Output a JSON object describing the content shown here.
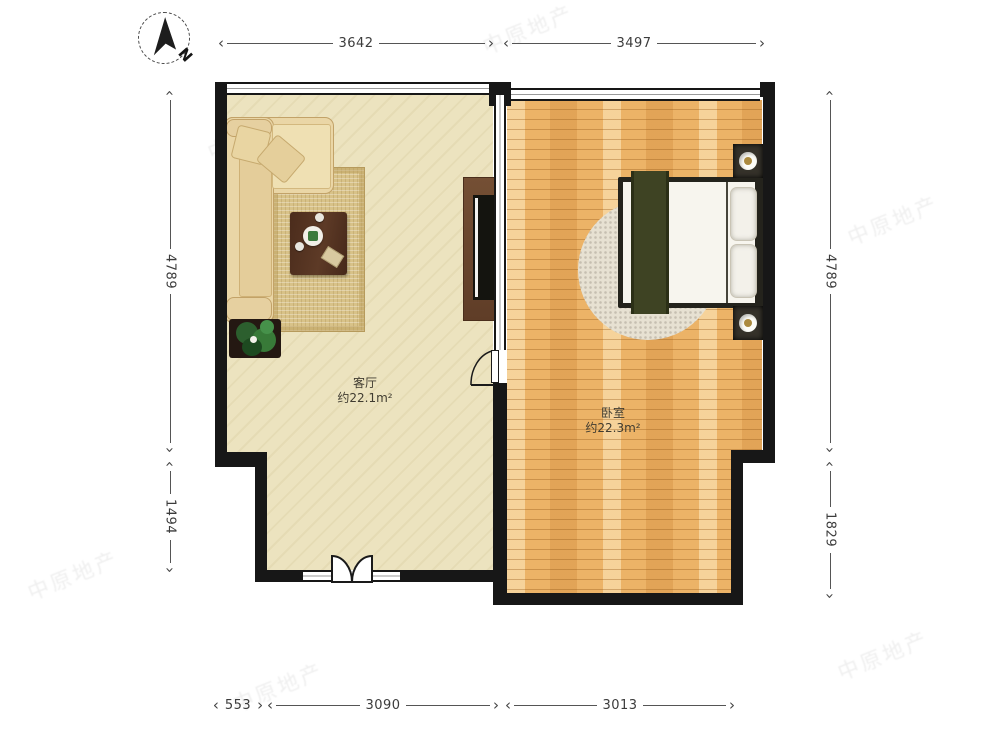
{
  "compass": {
    "label": "N"
  },
  "rooms": {
    "living": {
      "name": "客厅",
      "area": "约22.1m²"
    },
    "bedroom": {
      "name": "卧室",
      "area": "约22.3m²"
    }
  },
  "dims": {
    "top": [
      {
        "label": "3642"
      },
      {
        "label": "3497"
      }
    ],
    "bottom": [
      {
        "label": "553"
      },
      {
        "label": "3090"
      },
      {
        "label": "3013"
      }
    ],
    "left": [
      {
        "label": "4789"
      },
      {
        "label": "1494"
      }
    ],
    "right": [
      {
        "label": "4789"
      },
      {
        "label": "1829"
      }
    ]
  },
  "watermark": {
    "text": "中原地产"
  },
  "colors": {
    "wall": "#171717",
    "living_floor": "#ece3bf",
    "wood_floor": "#ecb367",
    "dim_line": "#555555"
  }
}
